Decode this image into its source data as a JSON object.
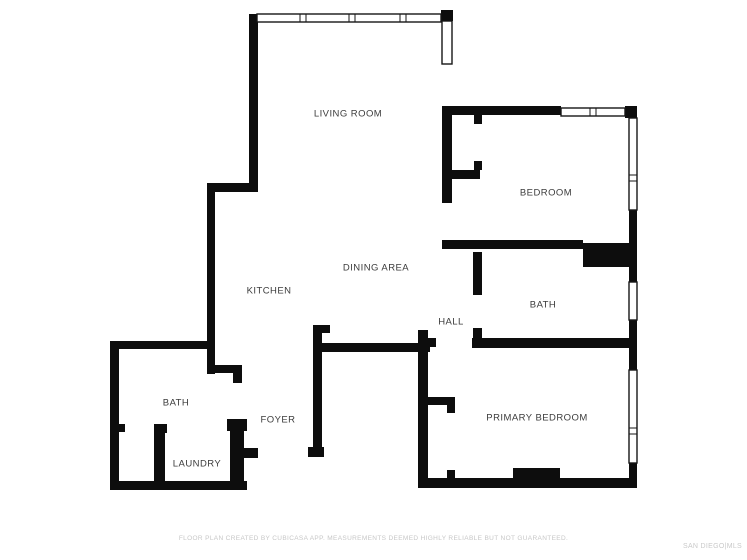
{
  "plan": {
    "background": "#ffffff",
    "wall_color": "#0d0d0d",
    "window_stroke": "#161616",
    "label_color": "#3c3c3c",
    "rooms": [
      {
        "name": "living-room",
        "label": "LIVING ROOM",
        "x": 348,
        "y": 114
      },
      {
        "name": "bedroom",
        "label": "BEDROOM",
        "x": 546,
        "y": 193
      },
      {
        "name": "kitchen",
        "label": "KITCHEN",
        "x": 269,
        "y": 291
      },
      {
        "name": "dining-area",
        "label": "DINING AREA",
        "x": 376,
        "y": 268
      },
      {
        "name": "hall",
        "label": "HALL",
        "x": 451,
        "y": 322
      },
      {
        "name": "bath-upper",
        "label": "BATH",
        "x": 543,
        "y": 305
      },
      {
        "name": "bath-lower",
        "label": "BATH",
        "x": 176,
        "y": 403
      },
      {
        "name": "foyer",
        "label": "FOYER",
        "x": 278,
        "y": 420
      },
      {
        "name": "laundry",
        "label": "LAUNDRY",
        "x": 197,
        "y": 464
      },
      {
        "name": "primary-bedroom",
        "label": "PRIMARY BEDROOM",
        "x": 537,
        "y": 418
      }
    ],
    "walls": [
      [
        249,
        14,
        9,
        178
      ],
      [
        207,
        183,
        50,
        9
      ],
      [
        207,
        183,
        8,
        191
      ],
      [
        441,
        10,
        12,
        11
      ],
      [
        442,
        106,
        119,
        9
      ],
      [
        625,
        106,
        12,
        12
      ],
      [
        442,
        106,
        10,
        97
      ],
      [
        442,
        170,
        38,
        9
      ],
      [
        474,
        115,
        8,
        9
      ],
      [
        474,
        161,
        8,
        9
      ],
      [
        442,
        240,
        141,
        9
      ],
      [
        583,
        243,
        47,
        24
      ],
      [
        629,
        210,
        8,
        72
      ],
      [
        629,
        320,
        8,
        50
      ],
      [
        629,
        463,
        8,
        25
      ],
      [
        473,
        252,
        9,
        43
      ],
      [
        473,
        328,
        9,
        20
      ],
      [
        472,
        338,
        165,
        10
      ],
      [
        317,
        343,
        113,
        9
      ],
      [
        313,
        325,
        9,
        132
      ],
      [
        313,
        325,
        17,
        8
      ],
      [
        308,
        447,
        16,
        10
      ],
      [
        418,
        330,
        10,
        158
      ],
      [
        428,
        338,
        8,
        9
      ],
      [
        418,
        478,
        219,
        10
      ],
      [
        428,
        397,
        27,
        8
      ],
      [
        447,
        405,
        8,
        8
      ],
      [
        447,
        470,
        8,
        9
      ],
      [
        513,
        468,
        47,
        12
      ],
      [
        110,
        341,
        105,
        8
      ],
      [
        110,
        341,
        9,
        149
      ],
      [
        110,
        481,
        137,
        9
      ],
      [
        230,
        419,
        14,
        71
      ],
      [
        227,
        419,
        20,
        12
      ],
      [
        238,
        448,
        20,
        10
      ],
      [
        154,
        424,
        11,
        58
      ],
      [
        154,
        424,
        13,
        9
      ],
      [
        119,
        424,
        6,
        8
      ],
      [
        207,
        365,
        35,
        8
      ],
      [
        233,
        373,
        9,
        10
      ]
    ],
    "windows": [
      {
        "x": 257,
        "y": 14,
        "w": 184,
        "h": 8,
        "orient": "h",
        "mullions": [
          303,
          352,
          403
        ]
      },
      {
        "x": 442,
        "y": 21,
        "w": 10,
        "h": 43,
        "orient": "v",
        "mullions": []
      },
      {
        "x": 561,
        "y": 108,
        "w": 64,
        "h": 8,
        "orient": "h",
        "mullions": [
          593
        ]
      },
      {
        "x": 629,
        "y": 118,
        "w": 8,
        "h": 92,
        "orient": "v",
        "mullions": [
          178
        ]
      },
      {
        "x": 629,
        "y": 282,
        "w": 8,
        "h": 38,
        "orient": "v",
        "mullions": []
      },
      {
        "x": 629,
        "y": 370,
        "w": 8,
        "h": 93,
        "orient": "v",
        "mullions": [
          431
        ]
      }
    ]
  },
  "footer": {
    "disclaimer": "FLOOR PLAN CREATED BY CUBICASA APP. MEASUREMENTS DEEMED HIGHLY RELIABLE BUT NOT GUARANTEED.",
    "watermark": "SAN DIEGO|MLS"
  }
}
